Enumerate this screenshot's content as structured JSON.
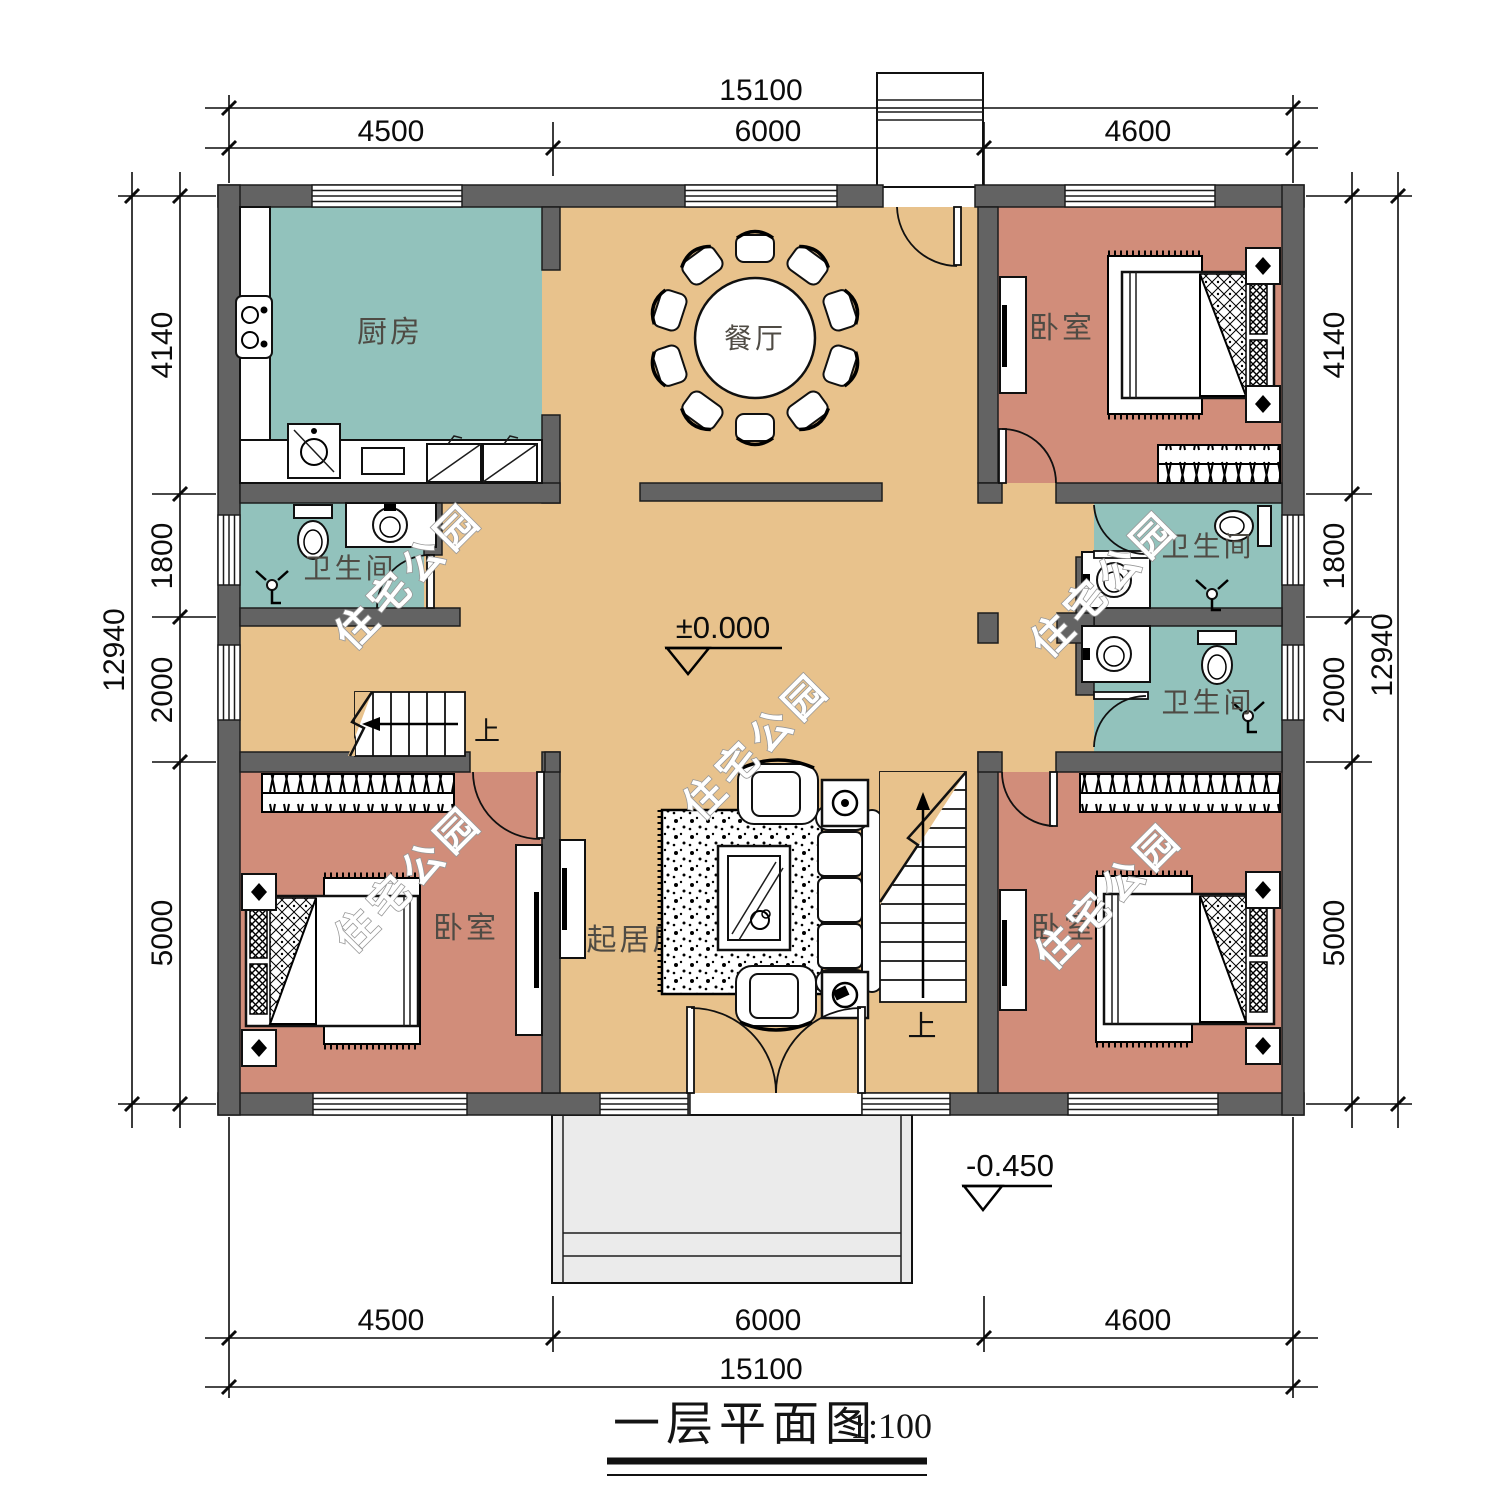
{
  "title": {
    "text": "一层平面图",
    "scale": "1:100"
  },
  "watermark": "住宅公园",
  "rooms": {
    "kitchen": "厨房",
    "dining": "餐厅",
    "living": "起居厅",
    "bedroom": "卧室",
    "bathroom": "卫生间"
  },
  "stair_up": "上",
  "levels": {
    "floor": "±0.000",
    "porch": "-0.450"
  },
  "dims": {
    "total_w": "15100",
    "total_h": "12940",
    "top": [
      "4500",
      "6000",
      "4600"
    ],
    "bottom": [
      "4500",
      "6000",
      "4600"
    ],
    "left": [
      "4140",
      "1800",
      "2000",
      "5000"
    ],
    "right": [
      "4140",
      "1800",
      "2000",
      "5000"
    ]
  },
  "colors": {
    "wall": "#636363",
    "hall_floor": "#e8c28c",
    "wet_floor": "#92c2bc",
    "bedroom_floor": "#d18d7a",
    "porch": "#ebebeb"
  }
}
